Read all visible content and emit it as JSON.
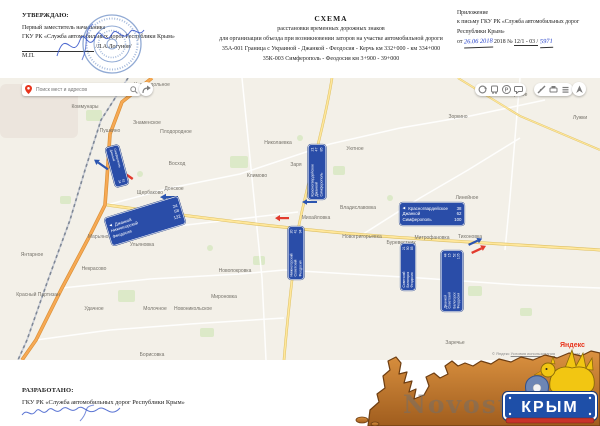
{
  "header": {
    "approve": {
      "title": "УТВЕРЖДАЮ:",
      "line1": "Первый заместитель начальника",
      "line2": "ГКУ РК «Служба автомобильных дорог Республики Крым»",
      "signature_name": "/Л.А.Логунов/",
      "mp": "М.П."
    },
    "scheme_title": {
      "t1": "СХЕМА",
      "t2": "расстановки временных дорожных знаков",
      "t3": "для организации объезда при возникновении заторов на участке автомобильной дороги",
      "t4": "35А-001 Граница с Украиной - Джанкой - Феодосия - Керчь км 332+000 - км 334+000",
      "t5": "35К-003 Симферополь - Феодосия км 3+900 - 39+000"
    },
    "annex": {
      "l1": "Приложение",
      "l2": "к письму ГКУ РК «Служба автомобильных дорог",
      "l3": "Республики Крым»",
      "from": "от",
      "hw_date": "26.06 2018",
      "year": "2018 №",
      "num": "12/1 - 03 /",
      "hw_num": "5971"
    }
  },
  "footer": {
    "developed": "РАЗРАБОТАНО:",
    "org": "ГКУ РК «Служба автомобильных дорог Республики Крым»"
  },
  "map": {
    "search": {
      "placeholder": "Поиск мест и адресов"
    },
    "attribution": {
      "copyright": "© Яндекс",
      "terms": "Условия использования",
      "scale": "2 км",
      "logo": "Яндекс"
    },
    "icons": {
      "left_arrow": "◀",
      "parking": "P"
    },
    "watermark": "Novosti-",
    "logo": {
      "text": "КРЫМ"
    },
    "labels": [
      {
        "name": "Краснодольное"
      },
      {
        "name": "Коммунары"
      },
      {
        "name": "Знаменское"
      },
      {
        "name": "Плодородное"
      },
      {
        "name": "Пушкино"
      },
      {
        "name": "Широкое"
      },
      {
        "name": "Зоркино"
      },
      {
        "name": "Лужки"
      },
      {
        "name": "Восход"
      },
      {
        "name": "Щербаково"
      },
      {
        "name": "Донское"
      },
      {
        "name": "Николаевка"
      },
      {
        "name": "Заря"
      },
      {
        "name": "Климово"
      },
      {
        "name": "Уютное"
      },
      {
        "name": "Владиславовка"
      },
      {
        "name": "Михайловка"
      },
      {
        "name": "Новогригорьевка"
      },
      {
        "name": "Буревестник"
      },
      {
        "name": "Червоное"
      },
      {
        "name": "Линейное"
      },
      {
        "name": "Митрофановка"
      },
      {
        "name": "Тихоновка"
      },
      {
        "name": "Марьяновка"
      },
      {
        "name": "Ульяновка"
      },
      {
        "name": "Янтарное"
      },
      {
        "name": "Некрасово"
      },
      {
        "name": "Красный Партизан"
      },
      {
        "name": "Удачное"
      },
      {
        "name": "Молочное"
      },
      {
        "name": "Новоникольское"
      },
      {
        "name": "Новопокровка"
      },
      {
        "name": "Мироновка"
      },
      {
        "name": "Заречье"
      },
      {
        "name": "Борисовка"
      }
    ],
    "signs": {
      "a": {
        "rows": [
          {
            "name": "Симферополь",
            "km": "52"
          },
          {
            "name": "Джанкой",
            "km": "24"
          }
        ]
      },
      "b": {
        "rows": [
          {
            "name": "Джанкой",
            "km": "24"
          },
          {
            "name": "Нижнегорский",
            "km": "58"
          },
          {
            "name": "Феодосия",
            "km": "132"
          }
        ]
      },
      "c": {
        "rows": [
          {
            "name": "Красногвардейское",
            "km": "21"
          },
          {
            "name": "Джанкой",
            "km": "47"
          },
          {
            "name": "Симферополь",
            "km": "85"
          }
        ]
      },
      "d": {
        "rows": [
          {
            "name": "Нижнегорский",
            "km": "20"
          },
          {
            "name": "Советский",
            "km": "41"
          },
          {
            "name": "Феодосия",
            "km": "94"
          }
        ]
      },
      "e": {
        "rows": [
          {
            "name": "Красногвардейское",
            "km": "38"
          },
          {
            "name": "Джанкой",
            "km": "62"
          },
          {
            "name": "Симферополь",
            "km": "100"
          }
        ]
      },
      "f": {
        "rows": [
          {
            "name": "Советский",
            "km": "21"
          },
          {
            "name": "Белогорск",
            "km": "50"
          },
          {
            "name": "Феодосия",
            "km": "85"
          }
        ]
      },
      "g": {
        "rows": [
          {
            "name": "Джанкой",
            "km": "44"
          },
          {
            "name": "Советский",
            "km": "15"
          },
          {
            "name": "Белогорск",
            "km": "52"
          },
          {
            "name": "Феодосия",
            "km": "105"
          }
        ]
      }
    }
  },
  "colors": {
    "sign_blue": "#2a4da8",
    "arrow_red": "#e23b2e",
    "arrow_blue": "#2b55b0",
    "land_brown": "#c07a2e",
    "banner_blue": "#1e4fa8"
  }
}
